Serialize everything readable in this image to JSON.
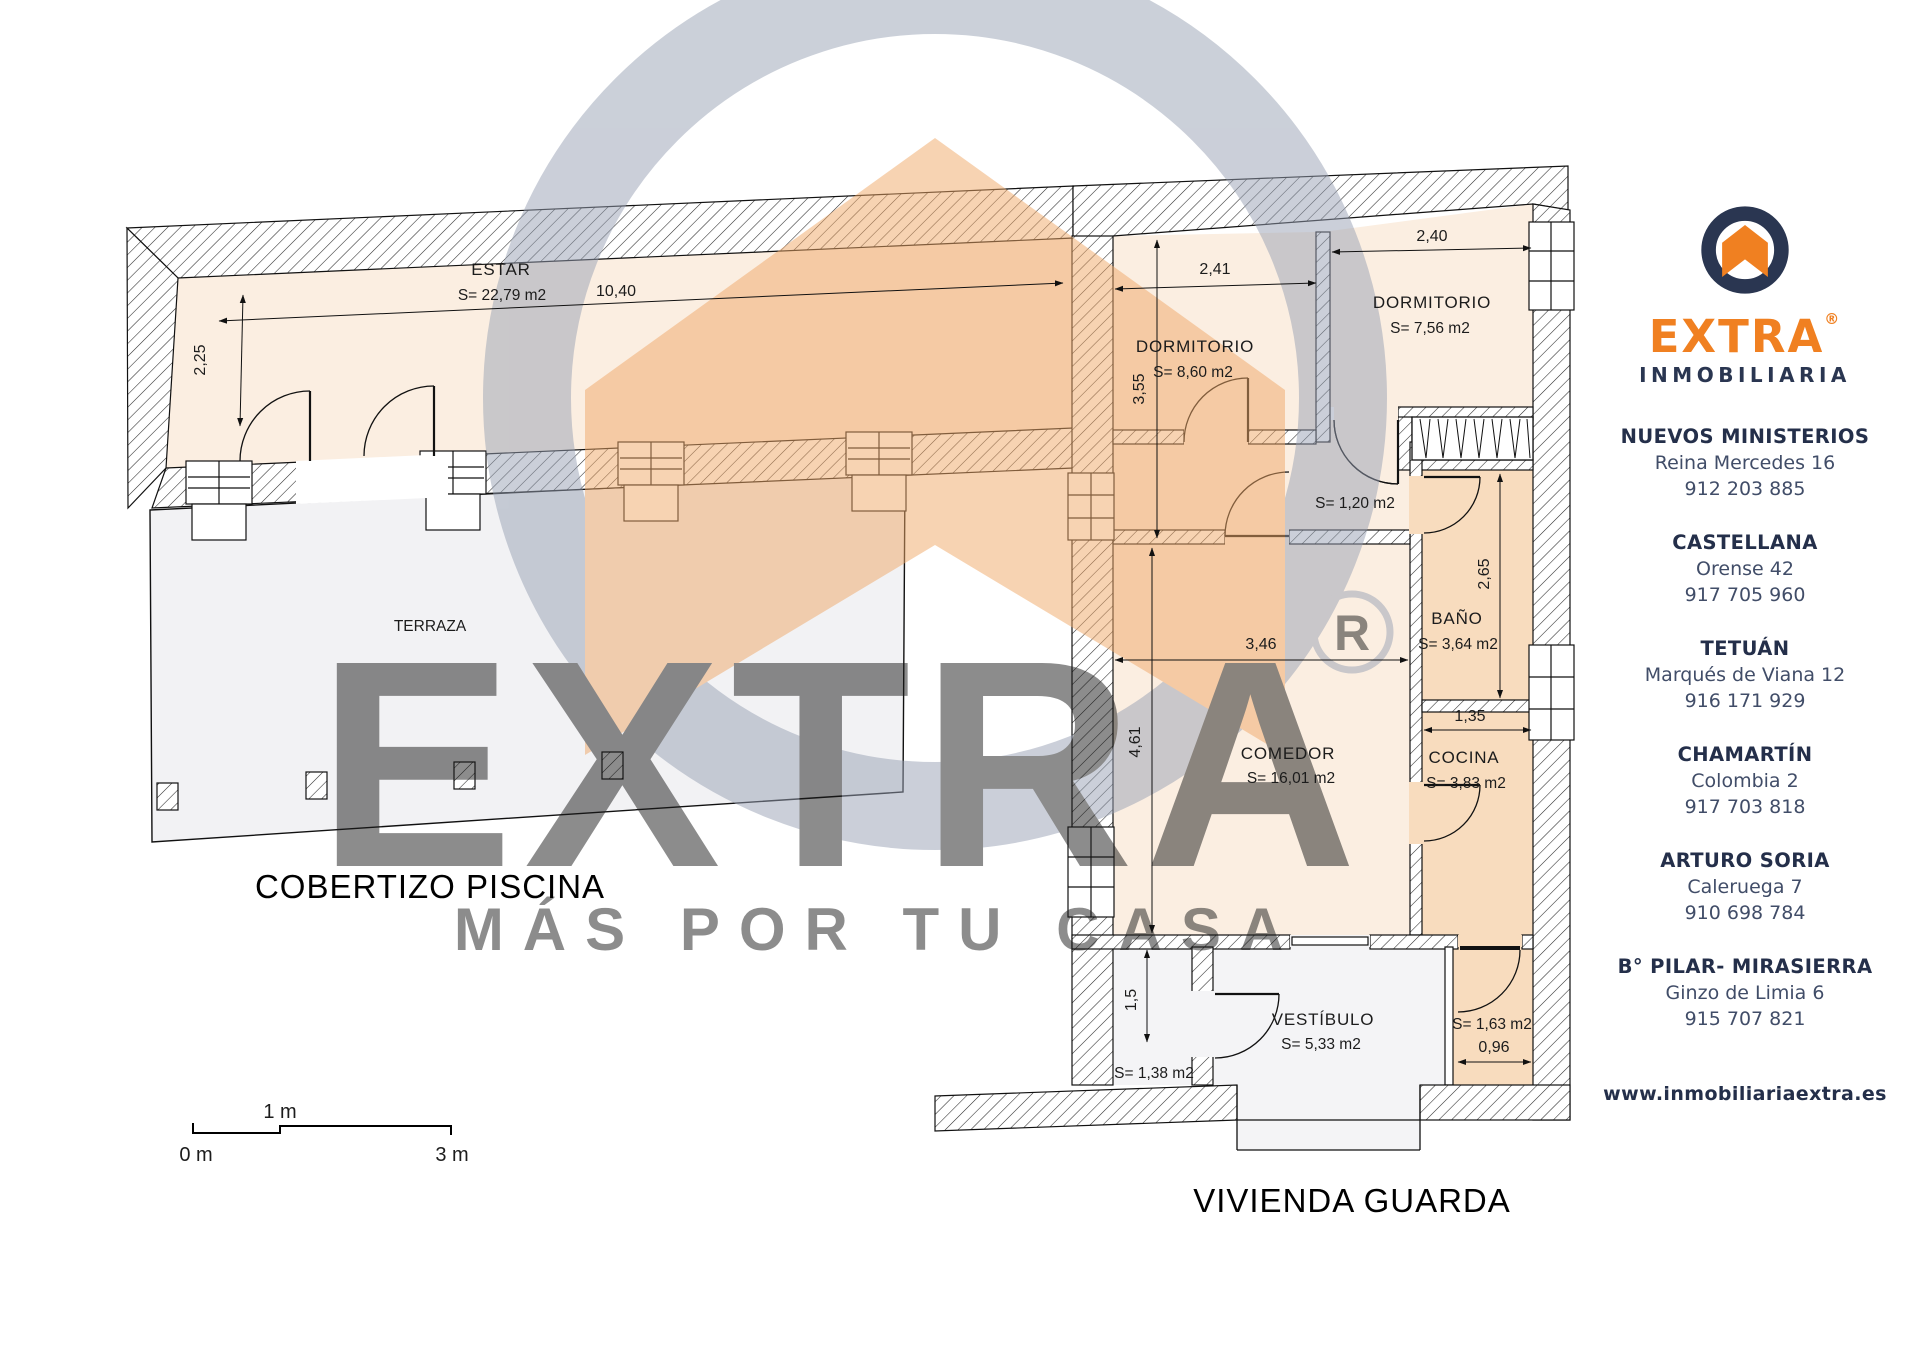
{
  "plan": {
    "rooms": [
      {
        "name": "ESTAR",
        "area": "S= 22,79 m2"
      },
      {
        "name": "TERRAZA"
      },
      {
        "name": "DORMITORIO",
        "area": "S= 8,60 m2"
      },
      {
        "name": "DORMITORIO",
        "area": "S= 7,56 m2"
      },
      {
        "area": "S= 1,20 m2"
      },
      {
        "name": "BAÑO",
        "area": "S= 3,64 m2"
      },
      {
        "name": "COCINA",
        "area": "S= 3,83 m2"
      },
      {
        "name": "COMEDOR",
        "area": "S= 16,01 m2"
      },
      {
        "name": "VESTÍBULO",
        "area": "S= 5,33 m2"
      },
      {
        "area": "S= 1,63 m2"
      },
      {
        "area": "S= 1,38 m2"
      }
    ],
    "dimensions": {
      "estar_w": "10,40",
      "estar_h": "2,25",
      "dorm1_w": "2,41",
      "dorm1_h": "3,55",
      "dorm2_w": "2,40",
      "comedor_w": "3,46",
      "comedor_h": "4,61",
      "bano_h": "2,65",
      "cocina_w": "1,35",
      "pasillo_w": "0,96",
      "aseo_h": "1,5"
    },
    "labels": {
      "cobertizo": "COBERTIZO PISCINA",
      "vivienda": "VIVIENDA GUARDA"
    },
    "scalebar": {
      "zero": "0 m",
      "one": "1 m",
      "three": "3 m"
    }
  },
  "watermark": {
    "brand": "EXTRA",
    "reg_letter": "R",
    "tagline": "MÁS POR TU CASA"
  },
  "sidebar": {
    "brand": "EXTRA",
    "registered": "®",
    "subtitle": "INMOBILIARIA",
    "offices": [
      {
        "name": "NUEVOS MINISTERIOS",
        "address": "Reina Mercedes 16",
        "phone": "912 203 885"
      },
      {
        "name": "CASTELLANA",
        "address": "Orense 42",
        "phone": "917 705 960"
      },
      {
        "name": "TETUÁN",
        "address": "Marqués de Viana 12",
        "phone": "916 171 929"
      },
      {
        "name": "CHAMARTÍN",
        "address": "Colombia 2",
        "phone": "917 703 818"
      },
      {
        "name": "ARTURO SORIA",
        "address": "Caleruega 7",
        "phone": "910 698 784"
      },
      {
        "name": "B° PILAR- MIRASIERRA",
        "address": "Ginzo de Limia 6",
        "phone": "915 707 821"
      }
    ],
    "website": "www.inmobiliariaextra.es"
  },
  "colors": {
    "accent_orange": "#F08021",
    "navy": "#2A3651",
    "room_peach": "#FBEEE1",
    "room_orange": "#F8DCBE",
    "terrace_gray": "#F2F2F4"
  }
}
